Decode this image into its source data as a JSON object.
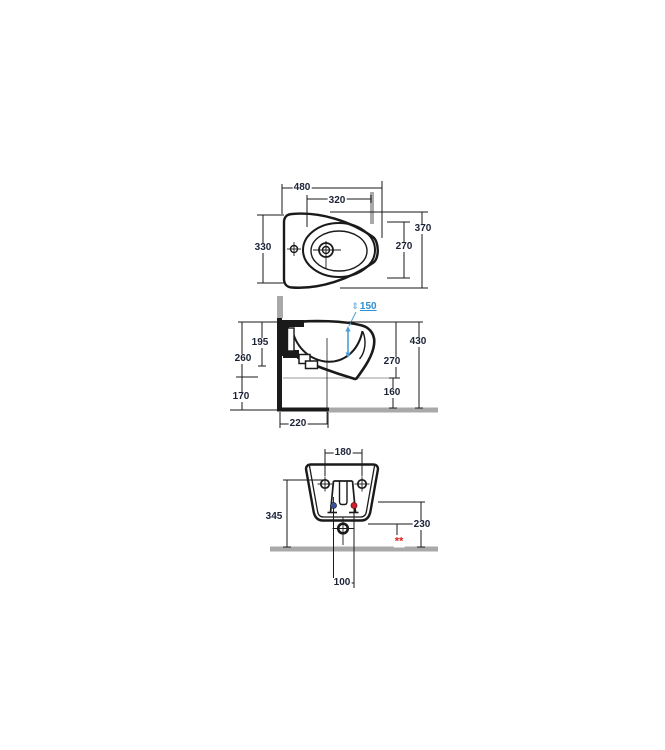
{
  "drawing": {
    "title": "wall-hung bidet technical installation drawing, three orthographic views",
    "colors": {
      "line": "#1a1a1a",
      "dimension_text": "#1c2336",
      "wall_gray": "#a9a9a9",
      "reference_gray": "#999999",
      "accent_blue": "#2d8fd2",
      "cold_water_blue": "#3c50a0",
      "hot_water_red": "#cf2030",
      "marker_red": "#e02020"
    },
    "views": {
      "top": {
        "dims": {
          "d480": "480",
          "d320": "320",
          "d330": "330",
          "d370": "370",
          "d270": "270"
        }
      },
      "side": {
        "dims": {
          "d150": "150",
          "d430": "430",
          "d195": "195",
          "d260": "260",
          "d170": "170",
          "d270": "270",
          "d160": "160",
          "d220": "220"
        }
      },
      "front": {
        "dims": {
          "d180": "180",
          "d345": "345",
          "d230": "230",
          "d100": "100"
        },
        "footnote_marker": "**"
      }
    },
    "icons": {
      "updown_arrow": "⇕"
    }
  }
}
